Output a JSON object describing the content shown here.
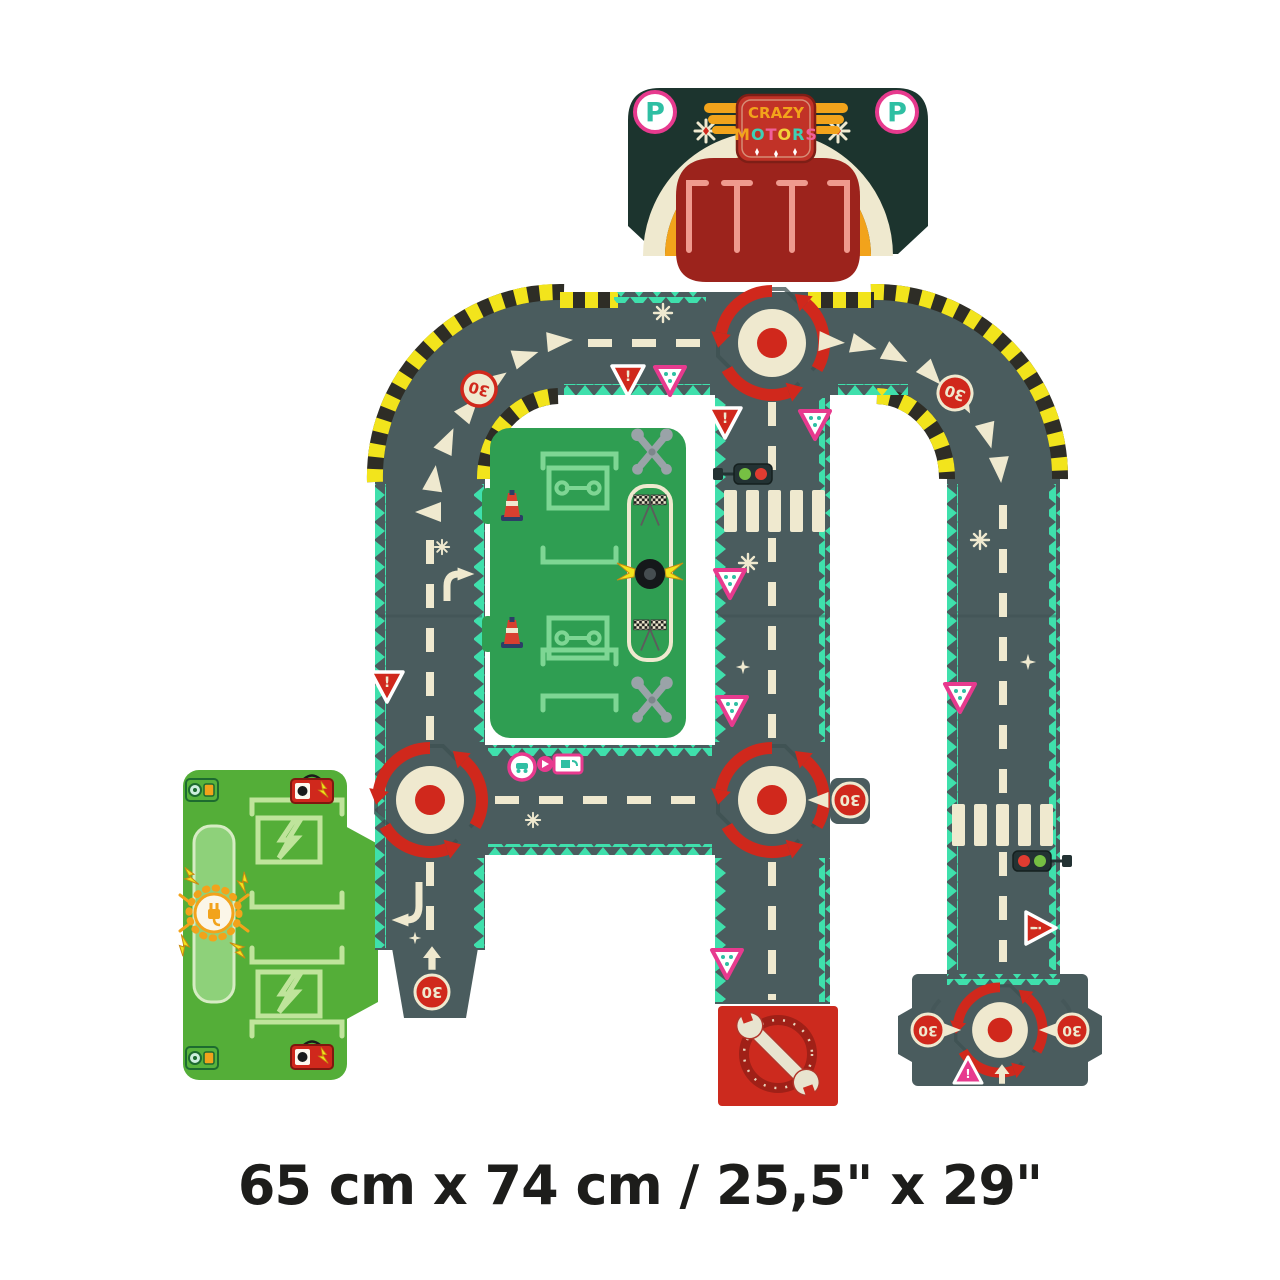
{
  "palette": {
    "bg": "#ffffff",
    "road": "#4a5c5e",
    "road-seam": "#3e5052",
    "teal": "#3fe0ac",
    "cream": "#efe9cf",
    "yellow": "#f2e41c",
    "hazard-dark": "#2e2d26",
    "red": "#d0281c",
    "dark-red": "#a02017",
    "bright-red": "#cc2a1e",
    "dark-teal": "#1c342e",
    "pink": "#e73a8e",
    "salmon": "#ef9a8e",
    "green": "#2f9e52",
    "light-green": "#7ed694",
    "bright-green": "#54ae38",
    "pale-green": "#bfe49b",
    "orange": "#f2a31b",
    "tool-gray": "#9aa3a8",
    "badge-teal": "#2fbfa3",
    "ink": "#1d1d1b"
  },
  "parking": {
    "p_badge_left": "P",
    "p_badge_right": "P",
    "logo": {
      "crazy": "CRAZY",
      "motors": [
        "M",
        "O",
        "T",
        "O",
        "R",
        "S"
      ]
    }
  },
  "signs": {
    "speed_limit": "30",
    "warning": "!"
  },
  "icons": {
    "roundabout-icon": "red circular arrows around dot",
    "speed-limit-sign": "red 30 roundel",
    "give-way-sign": "red triangle with !",
    "hazard-sign": "pink outlined triangle",
    "traffic-light-icon": "horizontal red/green light",
    "crosswalk": "zebra bars",
    "wrench-icon": "crossed workshop tools",
    "tire-icon": "winged racing tire",
    "checkered-flag-icon": "crossed finish flags",
    "cone-icon": "striped traffic cone",
    "charging-sun-icon": "sun with electric plug",
    "battery-icon": "battery with lightning bolt",
    "lightning-icon": "lightning bolt",
    "parking-icon": "P badge"
  },
  "footer": {
    "dimensions_label": "65 cm x 74 cm / 25,5\" x 29\""
  }
}
